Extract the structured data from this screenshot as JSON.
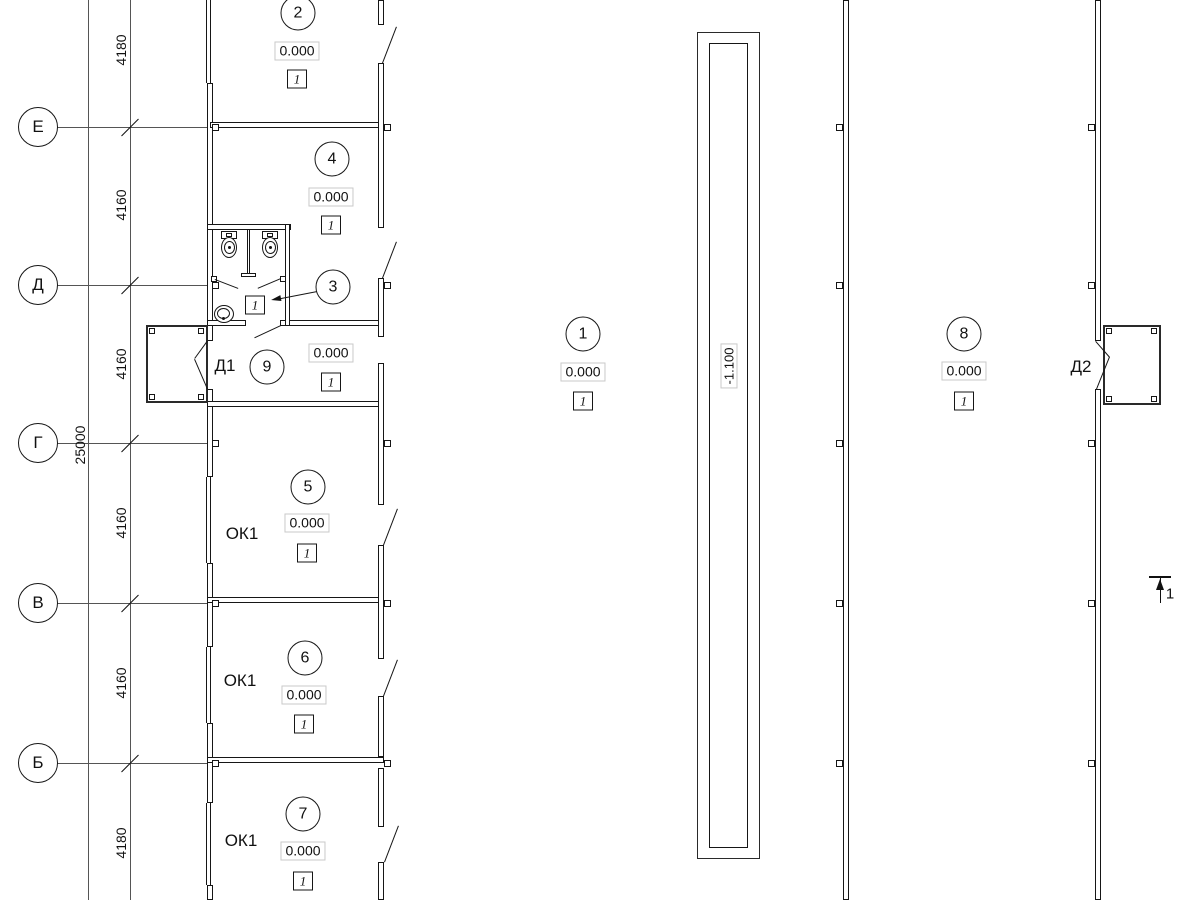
{
  "axes": {
    "labels": [
      "Е",
      "Д",
      "Г",
      "В",
      "Б"
    ]
  },
  "dimensions": {
    "segments": [
      "4180",
      "4160",
      "4160",
      "4160",
      "4160",
      "4180"
    ],
    "total": "25000"
  },
  "rooms": [
    {
      "number": "1",
      "elevation": "0.000",
      "floor_type": "1"
    },
    {
      "number": "2",
      "elevation": "0.000",
      "floor_type": "1"
    },
    {
      "number": "3",
      "floor_type": "1"
    },
    {
      "number": "4",
      "elevation": "0.000",
      "floor_type": "1"
    },
    {
      "number": "5",
      "elevation": "0.000",
      "floor_type": "1"
    },
    {
      "number": "6",
      "elevation": "0.000",
      "floor_type": "1"
    },
    {
      "number": "7",
      "elevation": "0.000",
      "floor_type": "1"
    },
    {
      "number": "8",
      "elevation": "0.000",
      "floor_type": "1"
    },
    {
      "number": "9",
      "elevation": "0.000",
      "floor_type": "1"
    }
  ],
  "ramp": {
    "elevation": "-1.100"
  },
  "doors": [
    {
      "label": "Д1"
    },
    {
      "label": "Д2"
    }
  ],
  "windows": [
    {
      "label": "ОК1"
    },
    {
      "label": "ОК1"
    },
    {
      "label": "ОК1"
    }
  ],
  "section_mark": {
    "label": "1"
  }
}
